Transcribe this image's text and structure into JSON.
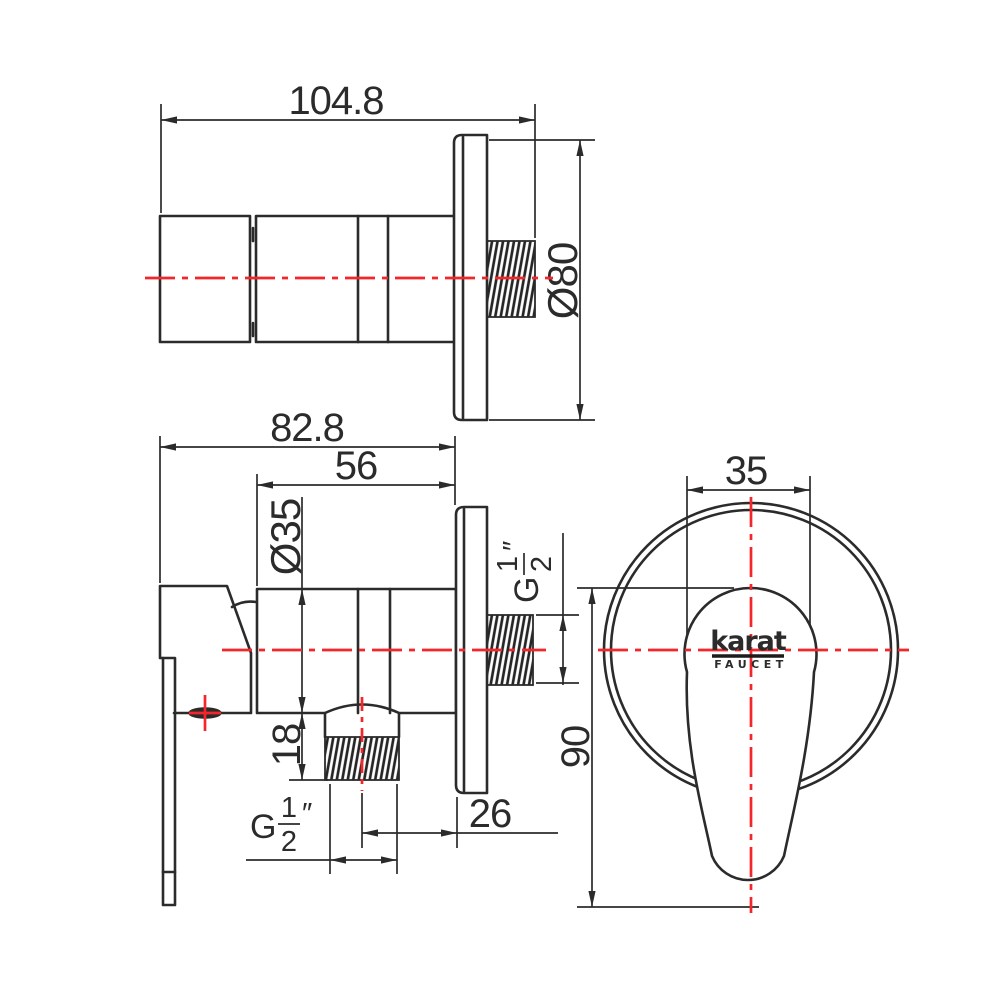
{
  "dimensions": {
    "top_length": "104.8",
    "flange_diameter": "Ø80",
    "front_overall_length": "82.8",
    "front_body_length": "56",
    "body_diameter": "Ø35",
    "bottom_thread_length": "18",
    "outlet_to_wall": "26",
    "handle_width": "35",
    "handle_height": "90"
  },
  "thread_spec": {
    "prefix": "G",
    "numerator": "1",
    "denominator": "2",
    "inch_mark": "″"
  },
  "brand": {
    "name": "karat",
    "tagline": "FAUCET"
  },
  "colors": {
    "line": "#2b2b2b",
    "centerline": "#f2262b",
    "background": "#ffffff"
  }
}
